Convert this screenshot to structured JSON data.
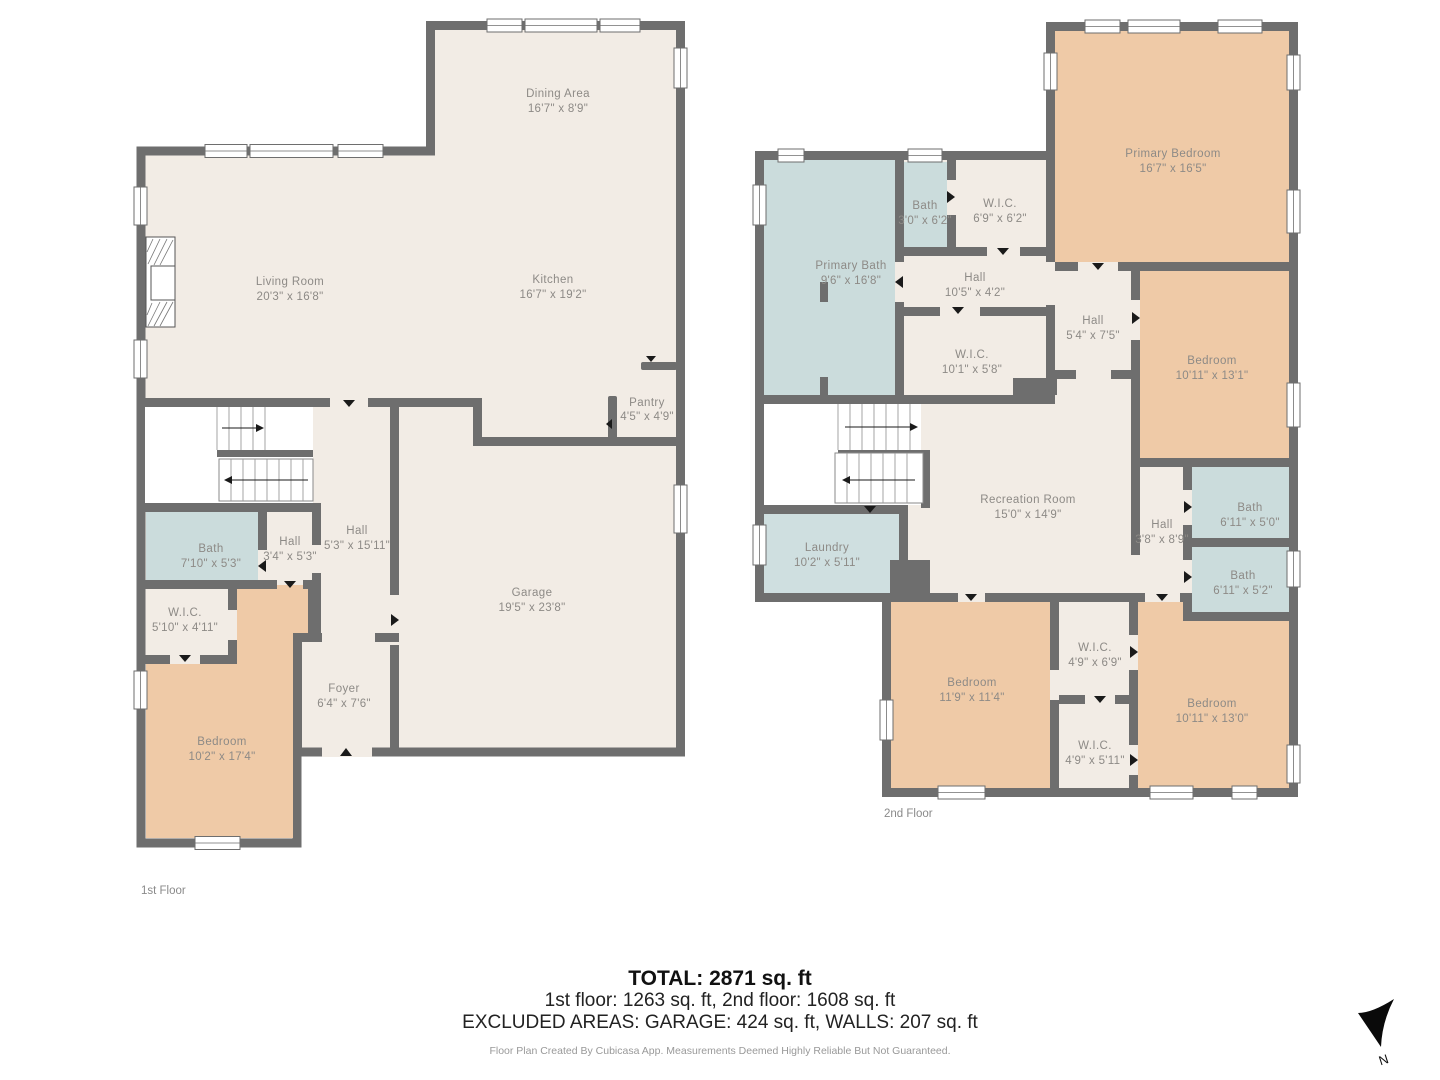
{
  "floor1": {
    "name": "1st Floor",
    "rooms": {
      "dining": {
        "label": "Dining Area",
        "dims": "16'7\" x 8'9\""
      },
      "living": {
        "label": "Living Room",
        "dims": "20'3\" x 16'8\""
      },
      "kitchen": {
        "label": "Kitchen",
        "dims": "16'7\" x 19'2\""
      },
      "pantry": {
        "label": "Pantry",
        "dims": "4'5\" x 4'9\""
      },
      "hall": {
        "label": "Hall",
        "dims": "5'3\" x 15'11\""
      },
      "hall_small": {
        "label": "Hall",
        "dims": "3'4\" x 5'3\""
      },
      "bath": {
        "label": "Bath",
        "dims": "7'10\" x 5'3\""
      },
      "wic": {
        "label": "W.I.C.",
        "dims": "5'10\" x 4'11\""
      },
      "bedroom": {
        "label": "Bedroom",
        "dims": "10'2\" x 17'4\""
      },
      "foyer": {
        "label": "Foyer",
        "dims": "6'4\" x 7'6\""
      },
      "garage": {
        "label": "Garage",
        "dims": "19'5\" x 23'8\""
      }
    }
  },
  "floor2": {
    "name": "2nd Floor",
    "rooms": {
      "primary_bedroom": {
        "label": "Primary Bedroom",
        "dims": "16'7\" x 16'5\""
      },
      "bath_top": {
        "label": "Bath",
        "dims": "3'0\" x 6'2\""
      },
      "wic_top": {
        "label": "W.I.C.",
        "dims": "6'9\" x 6'2\""
      },
      "primary_bath": {
        "label": "Primary Bath",
        "dims": "9'6\" x 16'8\""
      },
      "hall_upper": {
        "label": "Hall",
        "dims": "10'5\" x 4'2\""
      },
      "wic_mid": {
        "label": "W.I.C.",
        "dims": "10'1\" x 5'8\""
      },
      "hall_mid": {
        "label": "Hall",
        "dims": "5'4\" x 7'5\""
      },
      "bedroom_ne": {
        "label": "Bedroom",
        "dims": "10'11\" x 13'1\""
      },
      "recreation": {
        "label": "Recreation Room",
        "dims": "15'0\" x 14'9\""
      },
      "laundry": {
        "label": "Laundry",
        "dims": "10'2\" x 5'11\""
      },
      "hall_lower": {
        "label": "Hall",
        "dims": "3'8\" x 8'9\""
      },
      "bath_mid": {
        "label": "Bath",
        "dims": "6'11\" x 5'0\""
      },
      "bath_lower": {
        "label": "Bath",
        "dims": "6'11\" x 5'2\""
      },
      "bedroom_sw": {
        "label": "Bedroom",
        "dims": "11'9\" x 11'4\""
      },
      "wic_sw": {
        "label": "W.I.C.",
        "dims": "4'9\" x 6'9\""
      },
      "wic_s": {
        "label": "W.I.C.",
        "dims": "4'9\" x 5'11\""
      },
      "bedroom_se": {
        "label": "Bedroom",
        "dims": "10'11\" x 13'0\""
      }
    }
  },
  "summary": {
    "total": "TOTAL: 2871 sq. ft",
    "floors": "1st floor: 1263 sq. ft, 2nd floor: 1608 sq. ft",
    "excluded": "EXCLUDED AREAS: GARAGE: 424 sq. ft, WALLS: 207 sq. ft",
    "disclaimer": "Floor Plan Created By Cubicasa App. Measurements Deemed Highly Reliable But Not Guaranteed."
  },
  "compass": {
    "north_label": "N"
  },
  "colors": {
    "wall": "#6e6e6e",
    "floor": "#f2ece5",
    "bedroom": "#efcaa7",
    "bath": "#cbdcdc",
    "laundry": "#cfdfe0"
  }
}
